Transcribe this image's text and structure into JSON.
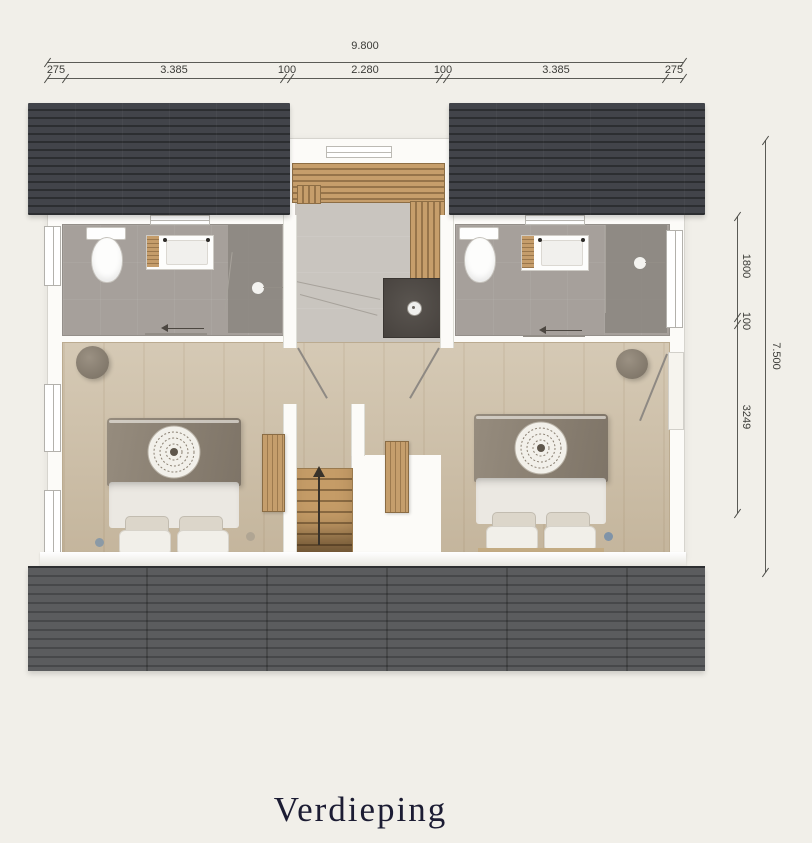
{
  "title": "Verdieping",
  "dimensions": {
    "top": {
      "total": "9.800",
      "segments": [
        "275",
        "3.385",
        "100",
        "2.280",
        "100",
        "3.385",
        "275"
      ]
    },
    "right": {
      "total": "7.500",
      "segments": [
        "1800",
        "100",
        "3249"
      ]
    }
  },
  "colors": {
    "background": "#f1efe9",
    "roof_top": "#3e4044",
    "roof_bottom": "#57585a",
    "wall": "#fcfbf8",
    "bath_floor": "#a6a09b",
    "wood_floor": "#cec0a8",
    "landing_floor": "#c9c5bf",
    "slat_wood": "#b9935f",
    "shower_dark": "#4e4945",
    "bed_blanket": "#8b8173",
    "bed_duvet": "#ebe8e2",
    "dimension_line": "#5a5a55",
    "title_color": "#1c1c33"
  },
  "fixtures": {
    "bathroom_left": [
      "toilet",
      "vanity-sink",
      "shower"
    ],
    "bathroom_right": [
      "toilet",
      "vanity-sink",
      "shower"
    ],
    "landing": [
      "wood-slat-wall",
      "shower-drain",
      "glass-screen"
    ],
    "hall": [
      "stairs-up"
    ],
    "bedroom_left": [
      "double-bed",
      "mandala-throw",
      "pouf",
      "wardrobe"
    ],
    "bedroom_right": [
      "double-bed",
      "mandala-throw",
      "pouf",
      "wardrobe"
    ]
  }
}
